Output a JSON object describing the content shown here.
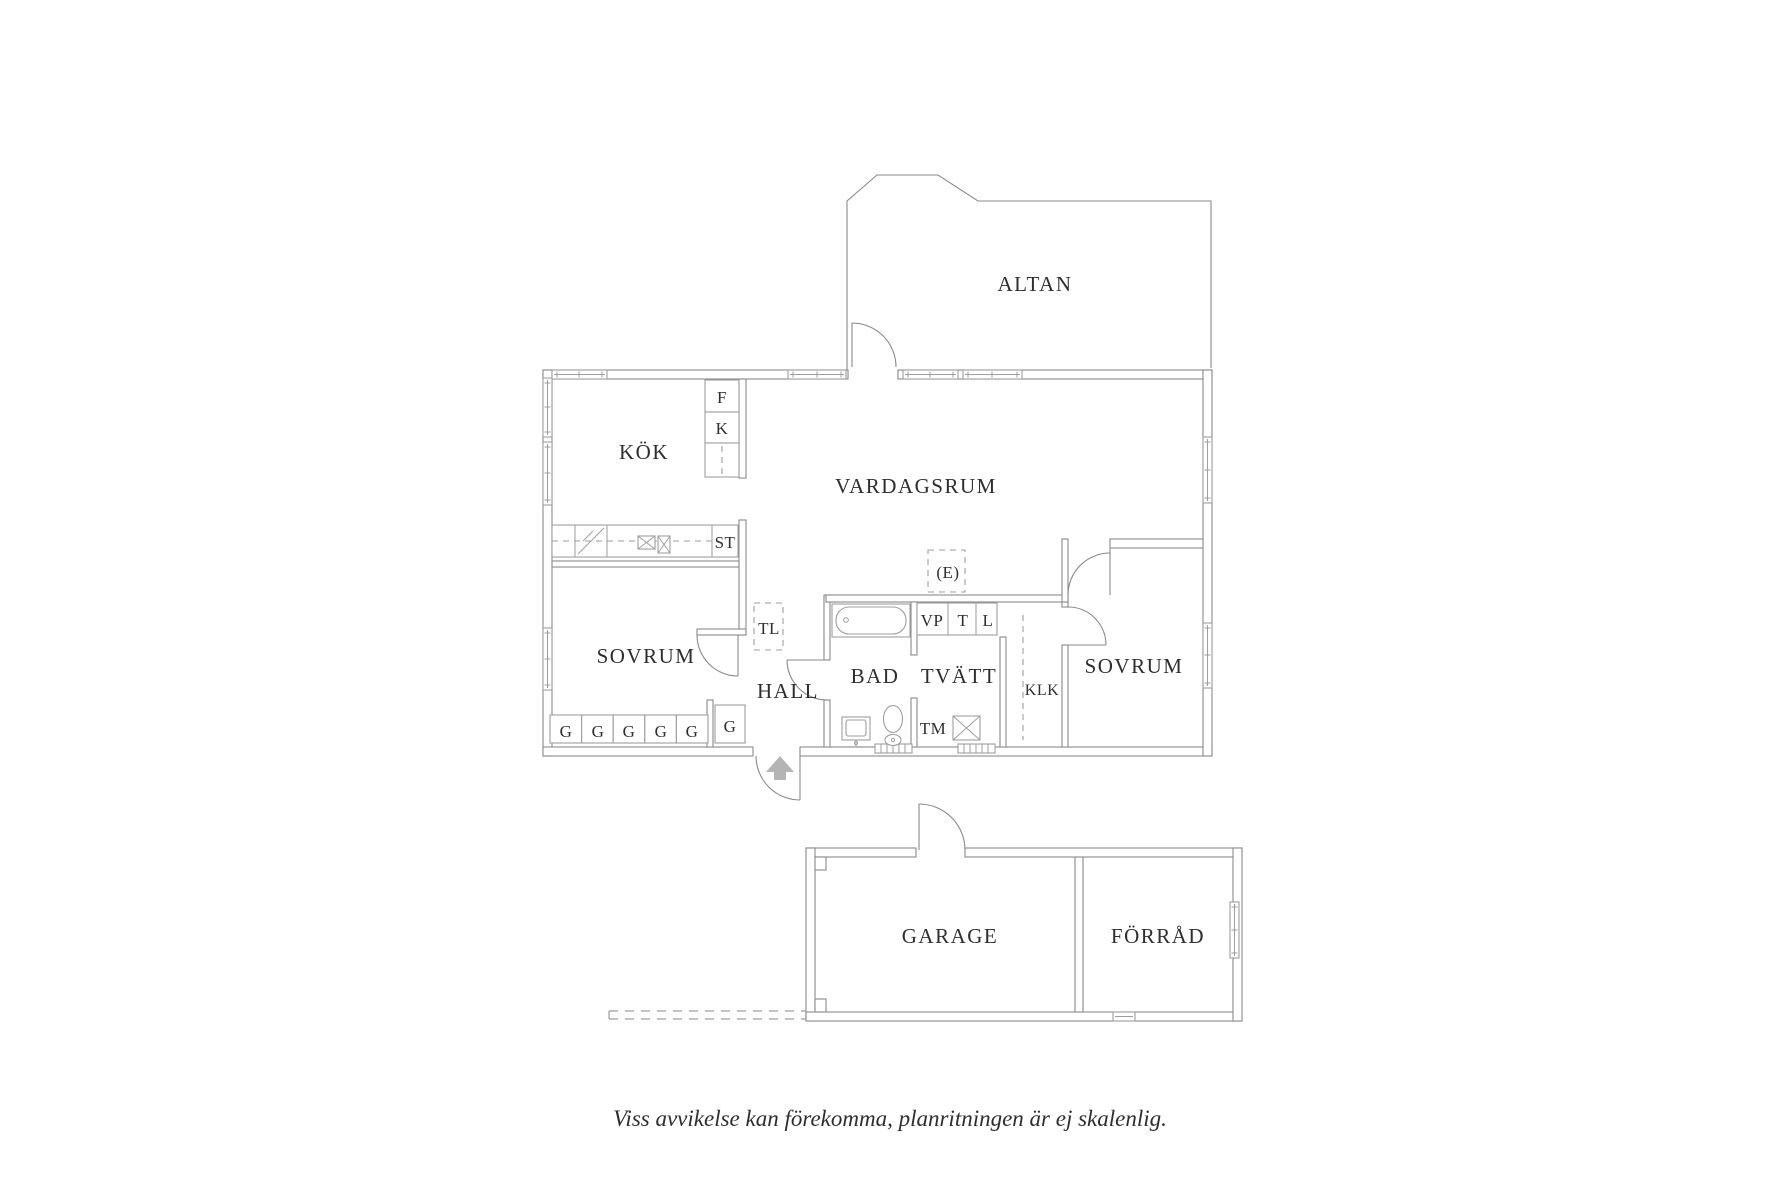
{
  "colors": {
    "background": "#ffffff",
    "wall_line": "#8a8a8a",
    "light_line": "#9e9e9e",
    "text": "#2e2e2e",
    "arrow": "#b4b4b4"
  },
  "floorplan": {
    "rooms": {
      "altan": "ALTAN",
      "kok": "KÖK",
      "vardagsrum": "VARDAGSRUM",
      "sovrum_left": "SOVRUM",
      "hall": "HALL",
      "bad": "BAD",
      "tvatt": "TVÄTT",
      "klk": "KLK",
      "sovrum_right": "SOVRUM",
      "garage": "GARAGE",
      "forrad": "FÖRRÅD"
    },
    "labels": {
      "f": "F",
      "k": "K",
      "st": "ST",
      "tl": "TL",
      "vp": "VP",
      "t": "T",
      "l": "L",
      "tm": "TM",
      "e": "(E)",
      "g1": "G",
      "g2": "G",
      "g3": "G",
      "g4": "G",
      "g5": "G",
      "g_hall": "G"
    }
  },
  "caption": "Viss avvikelse kan förekomma, planritningen är ej skalenlig."
}
